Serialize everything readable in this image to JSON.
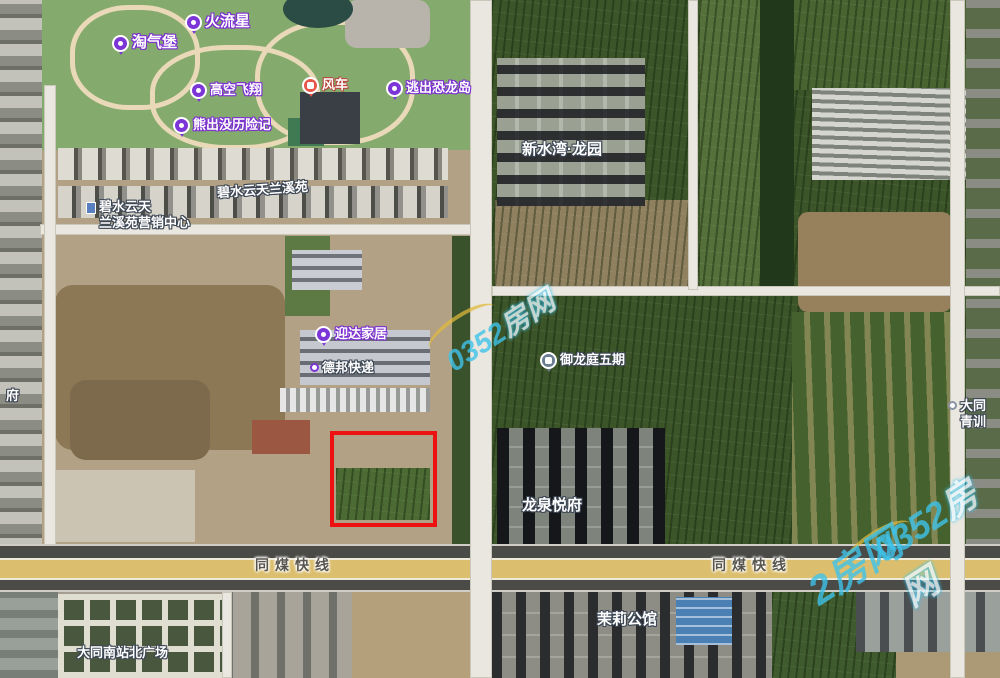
{
  "map": {
    "description": "satellite map with highlighted land parcel",
    "highlight_color": "#ee1111"
  },
  "pois": [
    {
      "text": "淘气堡"
    },
    {
      "text": "火流星"
    },
    {
      "text": "高空飞翔"
    },
    {
      "text": "熊出没历险记"
    },
    {
      "text": "风车"
    },
    {
      "text": "逃出恐龙岛"
    },
    {
      "text": "碧水云天兰溪苑"
    },
    {
      "line1": "碧水云天",
      "line2": "兰溪苑营销中心"
    },
    {
      "text": "新水湾·龙园"
    },
    {
      "text": "迎达家居"
    },
    {
      "text": "德邦快递"
    },
    {
      "text": "御龙庭五期"
    },
    {
      "text": "龙泉悦府"
    },
    {
      "text": "茉莉公馆"
    },
    {
      "text": "大同南站北广场"
    },
    {
      "line1": "大同",
      "line2": "青训"
    },
    {
      "text": "府"
    }
  ],
  "roads": {
    "expressway_label_left": "同煤快线",
    "expressway_label_right": "同煤快线"
  },
  "watermark": {
    "brand": "0352房网",
    "number": "0352",
    "name": "房网",
    "fragment": "2房网"
  }
}
